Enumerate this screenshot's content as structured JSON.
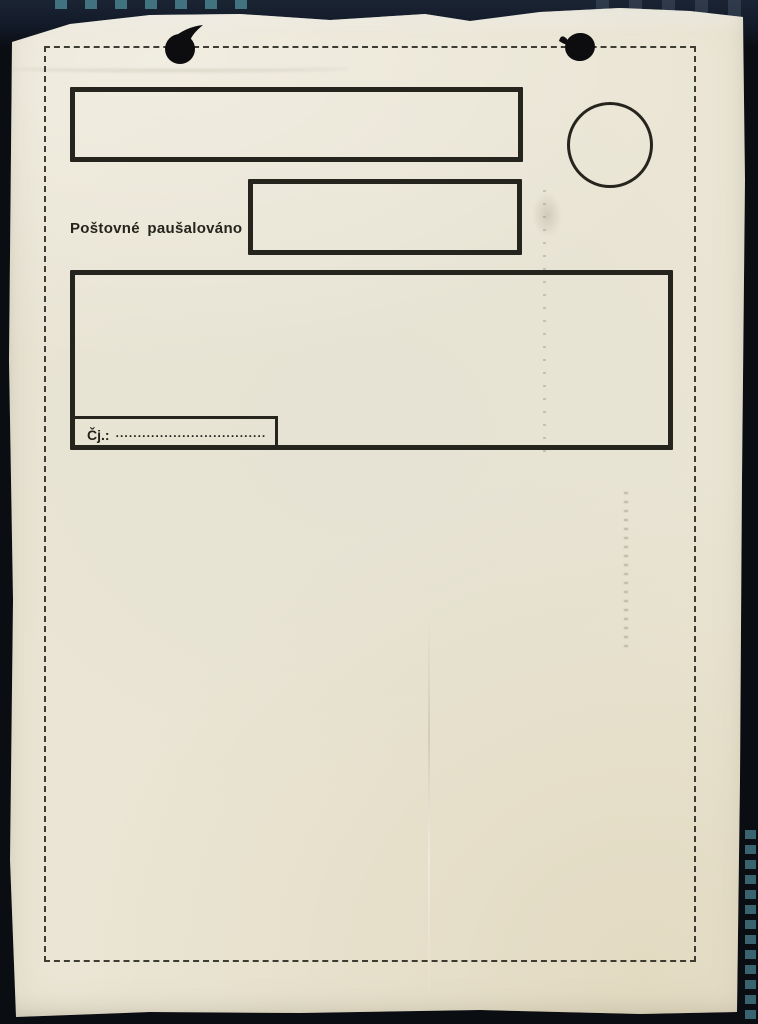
{
  "scan": {
    "background_color": "#0a0d12",
    "film_mark_color": "#47808e",
    "paper_color": "#eae5d4",
    "ink_color": "#26251d"
  },
  "form": {
    "postage_label": "Poštovné paušalováno",
    "reference_label": "Čj.:",
    "reference_leader": "........................................"
  },
  "icons": {
    "punch_hole_left": "punch-hole",
    "punch_hole_right": "punch-hole",
    "stamp_circle": "postmark-circle"
  }
}
